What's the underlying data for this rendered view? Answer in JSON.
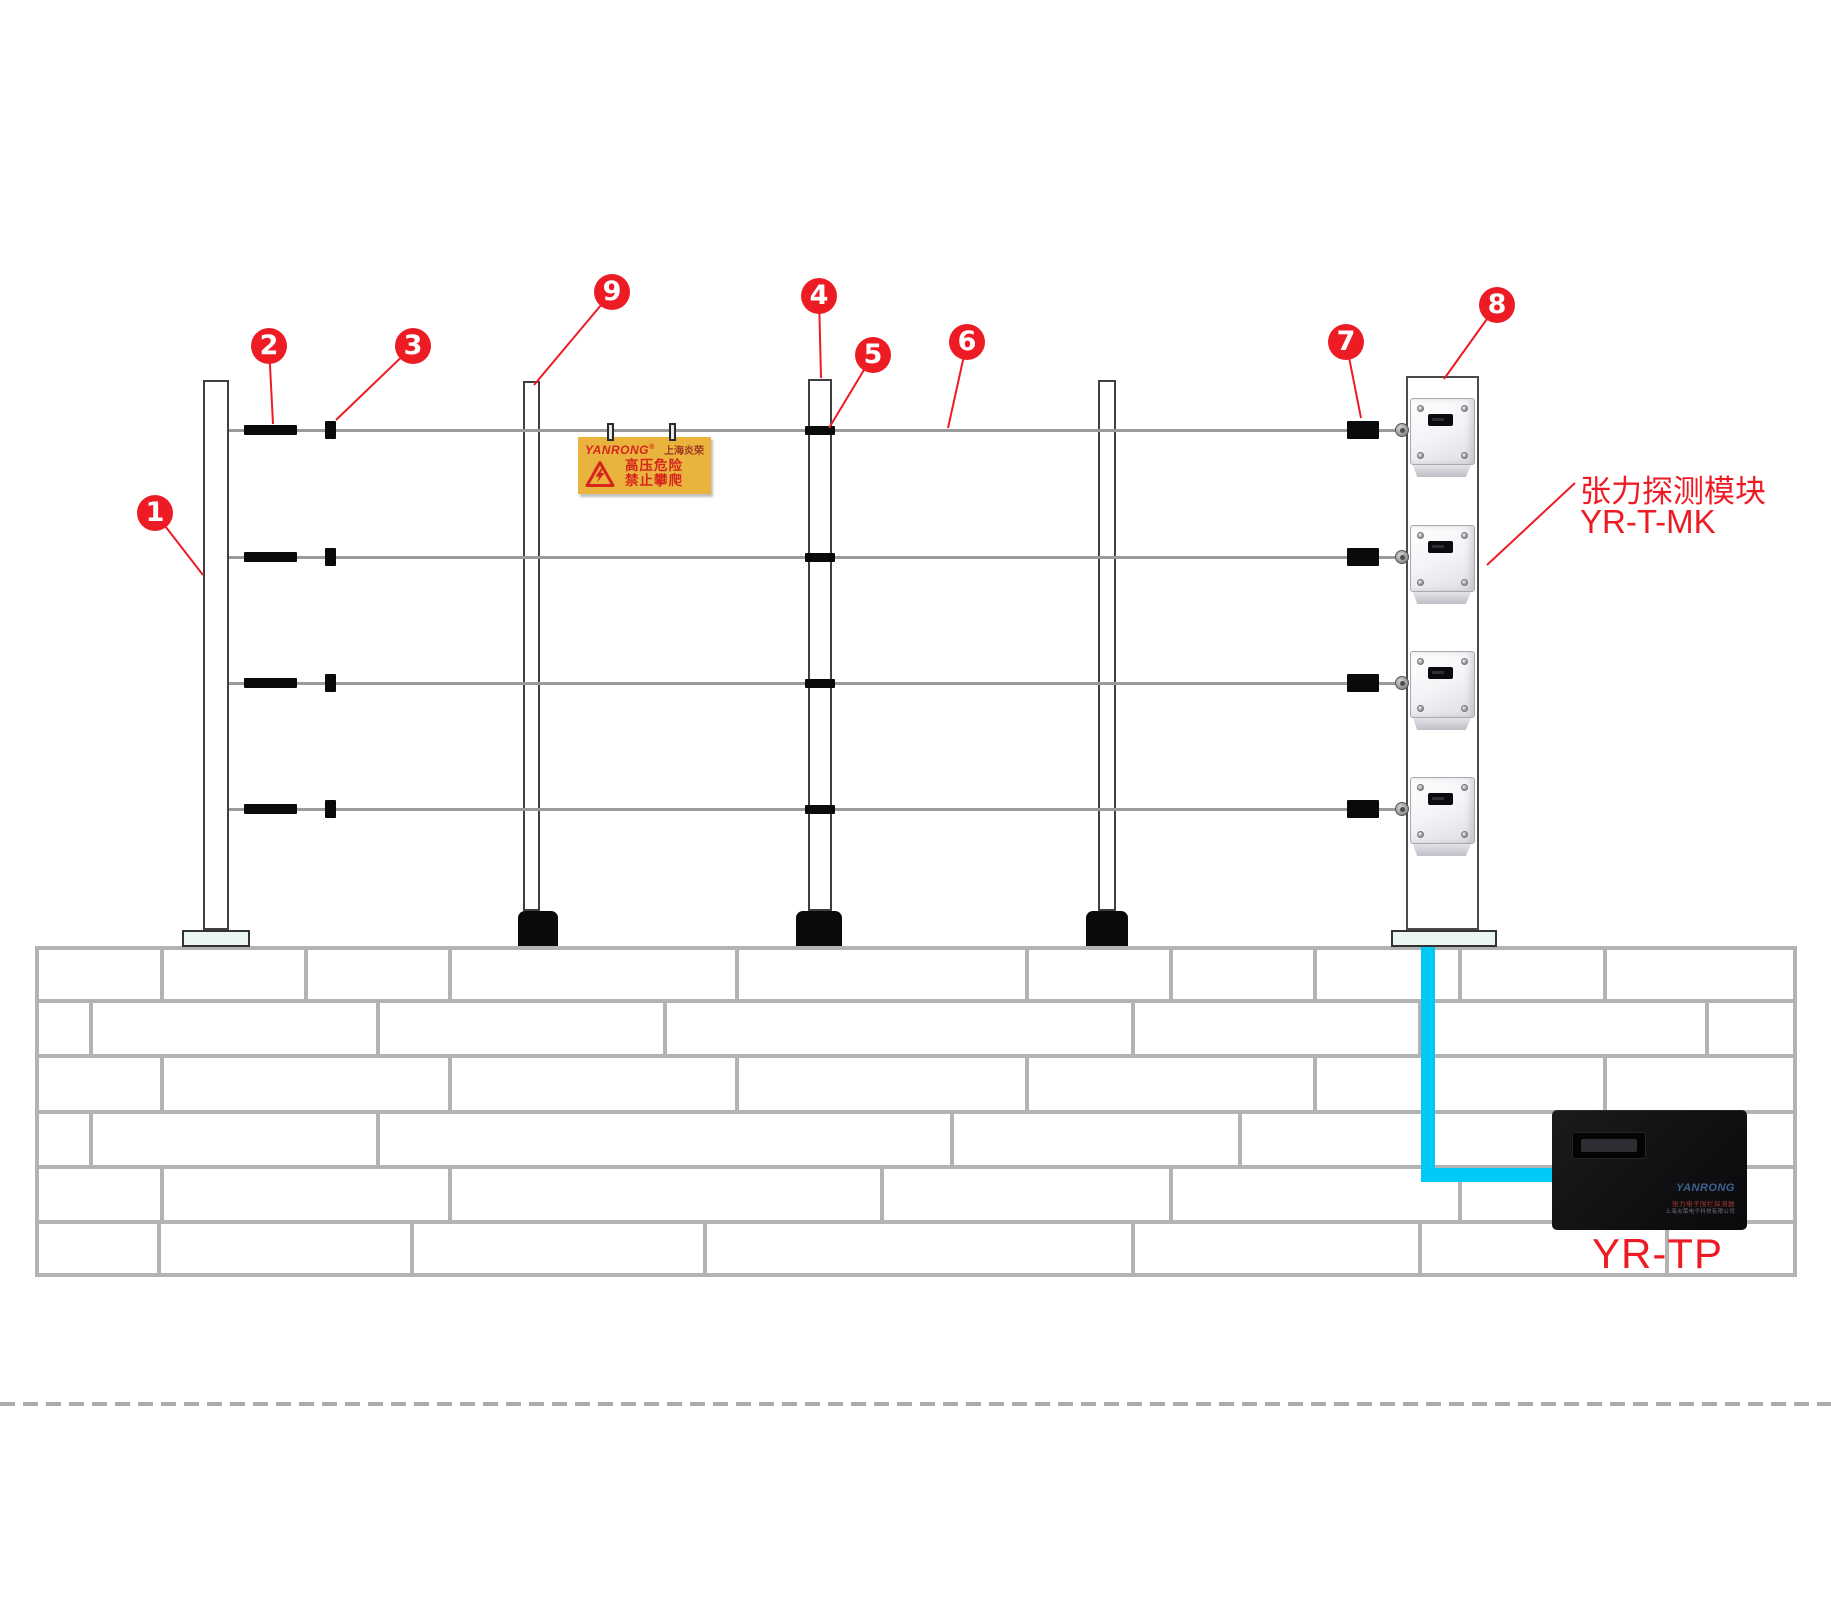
{
  "callouts": [
    {
      "label": "1"
    },
    {
      "label": "2"
    },
    {
      "label": "3"
    },
    {
      "label": "9"
    },
    {
      "label": "4"
    },
    {
      "label": "5"
    },
    {
      "label": "6"
    },
    {
      "label": "7"
    },
    {
      "label": "8"
    }
  ],
  "warning_sign": {
    "brand": "YANRONG",
    "reg": "®",
    "brand_cn": "上海炎荣",
    "line1": "高压危险",
    "line2": "禁止攀爬"
  },
  "module_label": {
    "line1": "张力探测模块",
    "line2": "YR-T-MK"
  },
  "controller": {
    "logo": "YANRONG",
    "line1": "张力电子围栏探测器",
    "line2": "上海炎荣电子科技有限公司",
    "label": "YR-TP"
  },
  "structure": {
    "wire_count": 4,
    "module_count": 4,
    "post_count": 5
  },
  "colors": {
    "accent": "#ed1c24",
    "cable": "#00c8f7",
    "sign_bg": "#eab33d"
  }
}
